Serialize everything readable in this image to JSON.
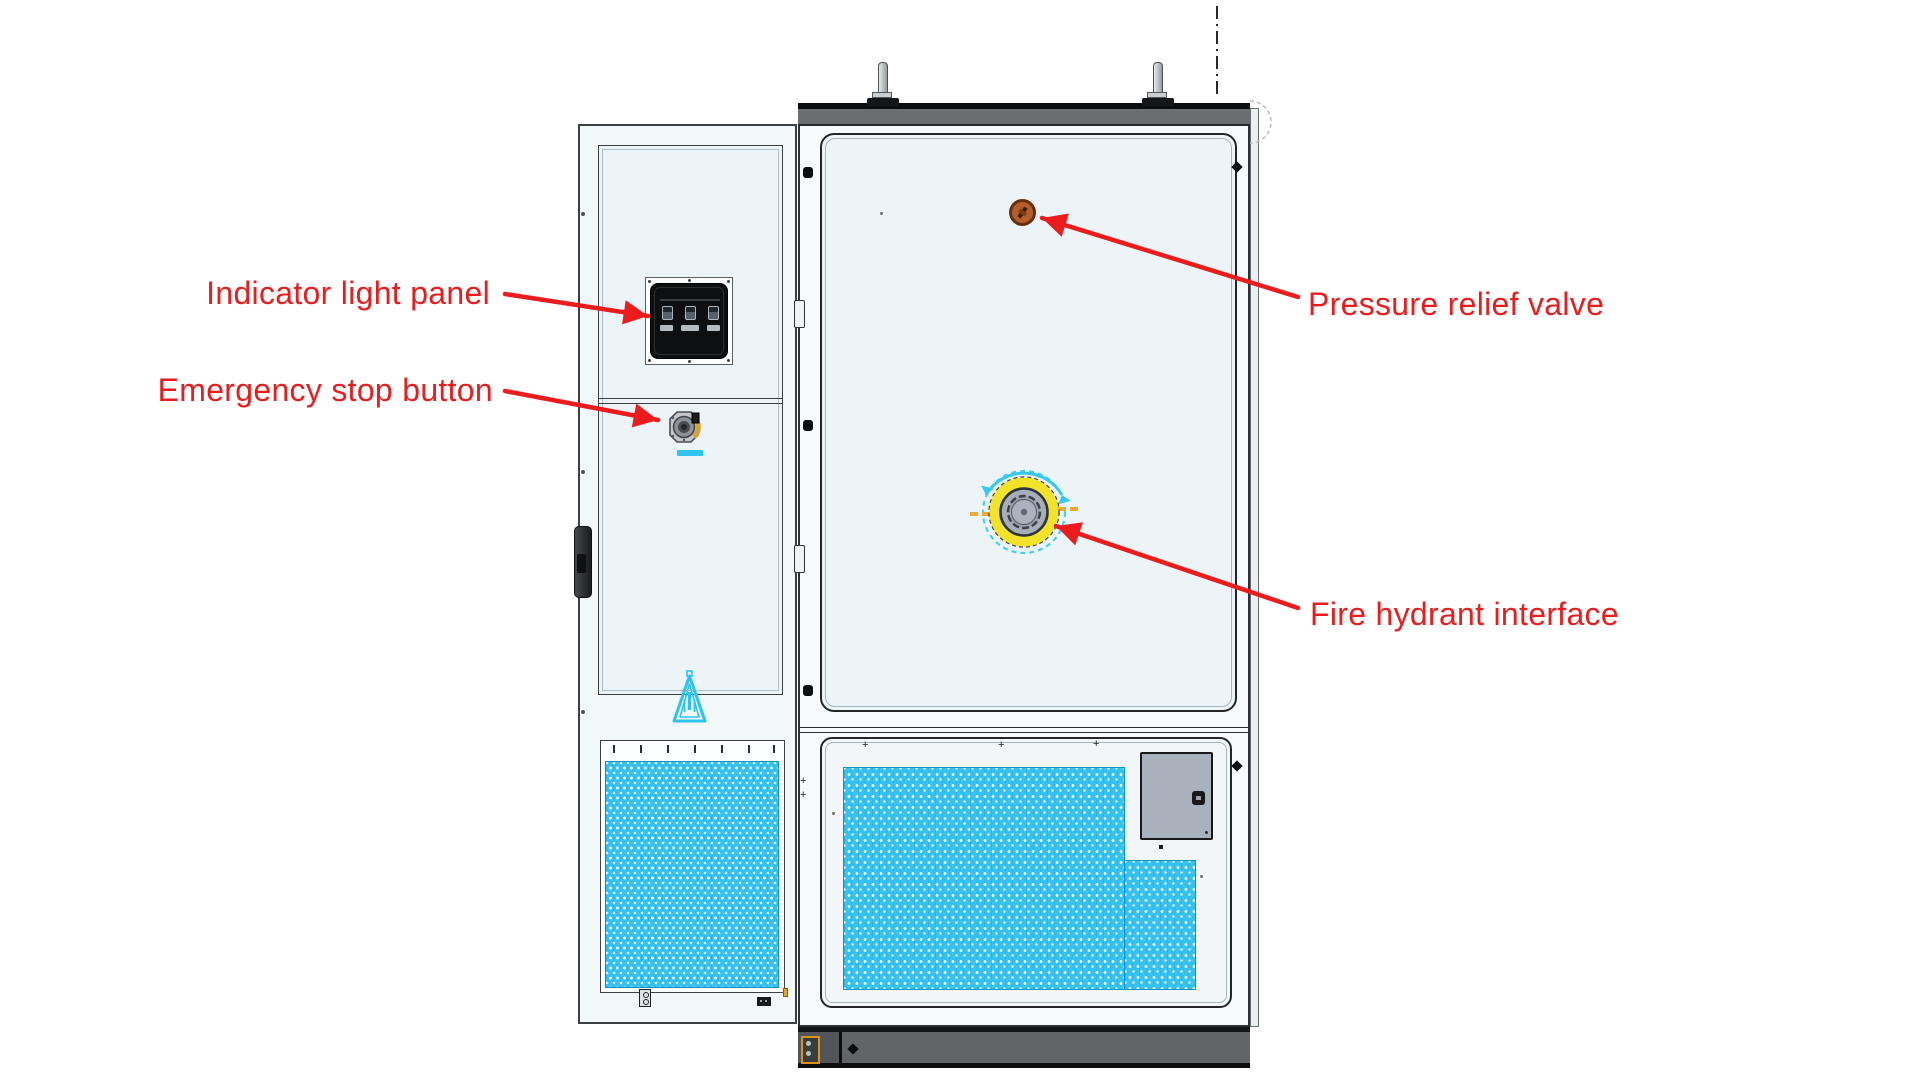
{
  "annotations": {
    "items": [
      {
        "id": "indicator-light-panel",
        "label": "Indicator light panel",
        "side": "left"
      },
      {
        "id": "emergency-stop-button",
        "label": "Emergency stop button",
        "side": "left"
      },
      {
        "id": "pressure-relief-valve",
        "label": "Pressure relief valve",
        "side": "right"
      },
      {
        "id": "fire-hydrant-interface",
        "label": "Fire hydrant interface",
        "side": "right"
      }
    ]
  },
  "colors": {
    "red": "#ec1b1c",
    "cyan": "#2ec6f1",
    "yellow": "#f0e32a",
    "ventblue": "#35c2f0",
    "valve_orange": "#b65d2c",
    "ground_orange": "#d9931c"
  },
  "components": [
    "left-auxiliary-cabinet",
    "right-main-cabinet",
    "indicator-light-panel",
    "emergency-stop-button",
    "pressure-relief-valve",
    "fire-hydrant-interface",
    "warning-triangle",
    "ventilation-grille-left",
    "ventilation-grille-right",
    "access-panel",
    "door-handle",
    "lifting-bolts",
    "cabinet-base"
  ]
}
